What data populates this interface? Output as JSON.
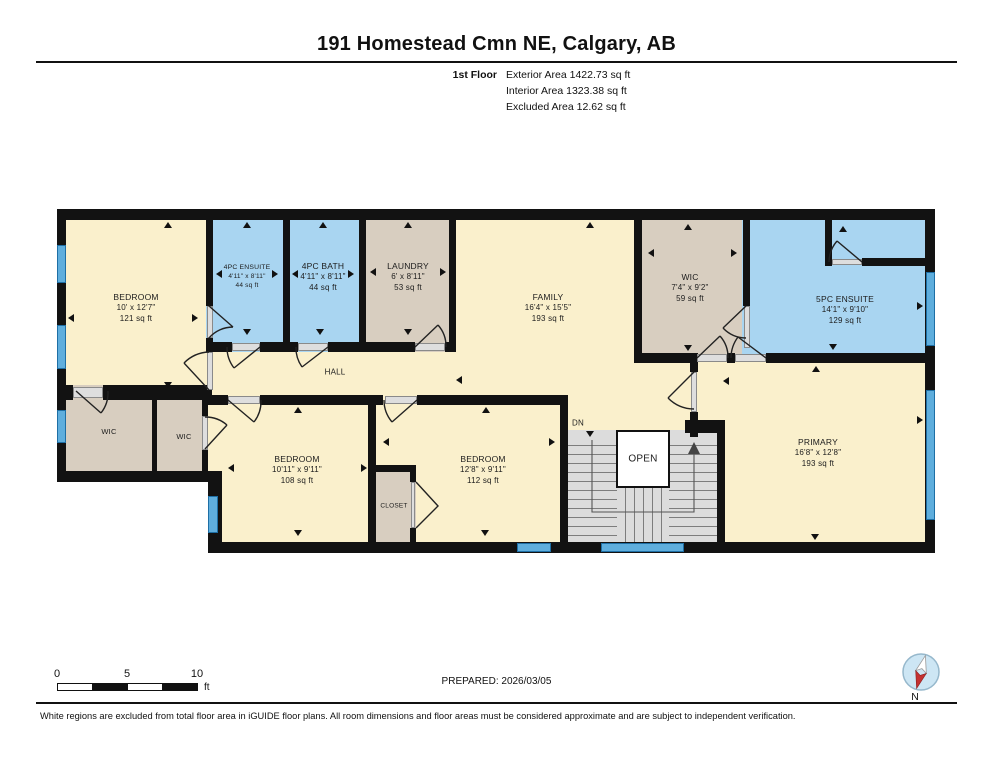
{
  "header": {
    "title": "191 Homestead Cmn NE, Calgary, AB",
    "floor_label": "1st Floor",
    "areas": [
      {
        "label": "Exterior Area",
        "value": "1422.73 sq ft"
      },
      {
        "label": "Interior Area",
        "value": "1323.38 sq ft"
      },
      {
        "label": "Excluded Area",
        "value": "12.62 sq ft"
      }
    ]
  },
  "rooms": {
    "bedroom1": {
      "name": "BEDROOM",
      "dims": "10' x 12'7\"",
      "area": "121 sq ft"
    },
    "ensuite4": {
      "name": "4PC ENSUITE",
      "dims": "4'11\" x 8'11\"",
      "area": "44 sq ft"
    },
    "bath4": {
      "name": "4PC BATH",
      "dims": "4'11\" x 8'11\"",
      "area": "44 sq ft"
    },
    "laundry": {
      "name": "LAUNDRY",
      "dims": "6' x 8'11\"",
      "area": "53 sq ft"
    },
    "family": {
      "name": "FAMILY",
      "dims": "16'4\" x 15'5\"",
      "area": "193 sq ft"
    },
    "wic_main": {
      "name": "WIC",
      "dims": "7'4\" x 9'2\"",
      "area": "59 sq ft"
    },
    "ensuite5": {
      "name": "5PC ENSUITE",
      "dims": "14'1\" x 9'10\"",
      "area": "129 sq ft"
    },
    "primary": {
      "name": "PRIMARY",
      "dims": "16'8\" x 12'8\"",
      "area": "193 sq ft"
    },
    "wic_a": {
      "name": "WIC"
    },
    "wic_b": {
      "name": "WIC"
    },
    "bedroom2": {
      "name": "BEDROOM",
      "dims": "10'11\" x 9'11\"",
      "area": "108 sq ft"
    },
    "bedroom3": {
      "name": "BEDROOM",
      "dims": "12'8\" x 9'11\"",
      "area": "112 sq ft"
    },
    "closet": {
      "name": "CLOSET"
    },
    "hall": {
      "name": "HALL"
    },
    "stairs": {
      "dn": "DN",
      "open": "OPEN"
    }
  },
  "footer": {
    "scale_ticks": [
      "0",
      "5",
      "10"
    ],
    "scale_unit": "ft",
    "prepared": "PREPARED: 2026/03/05",
    "compass_label": "N",
    "disclaimer": "White regions are excluded from total floor area in iGUIDE floor plans. All room dimensions and floor areas must be considered approximate and are subject to independent verification."
  },
  "colors": {
    "room_cream": "#FAF0CC",
    "room_blue": "#A9D5F1",
    "room_tan": "#D8CEC0",
    "wall": "#121212",
    "window": "#5FAEDD",
    "stairs": "#DCDCDC",
    "compass_red": "#C43131"
  }
}
